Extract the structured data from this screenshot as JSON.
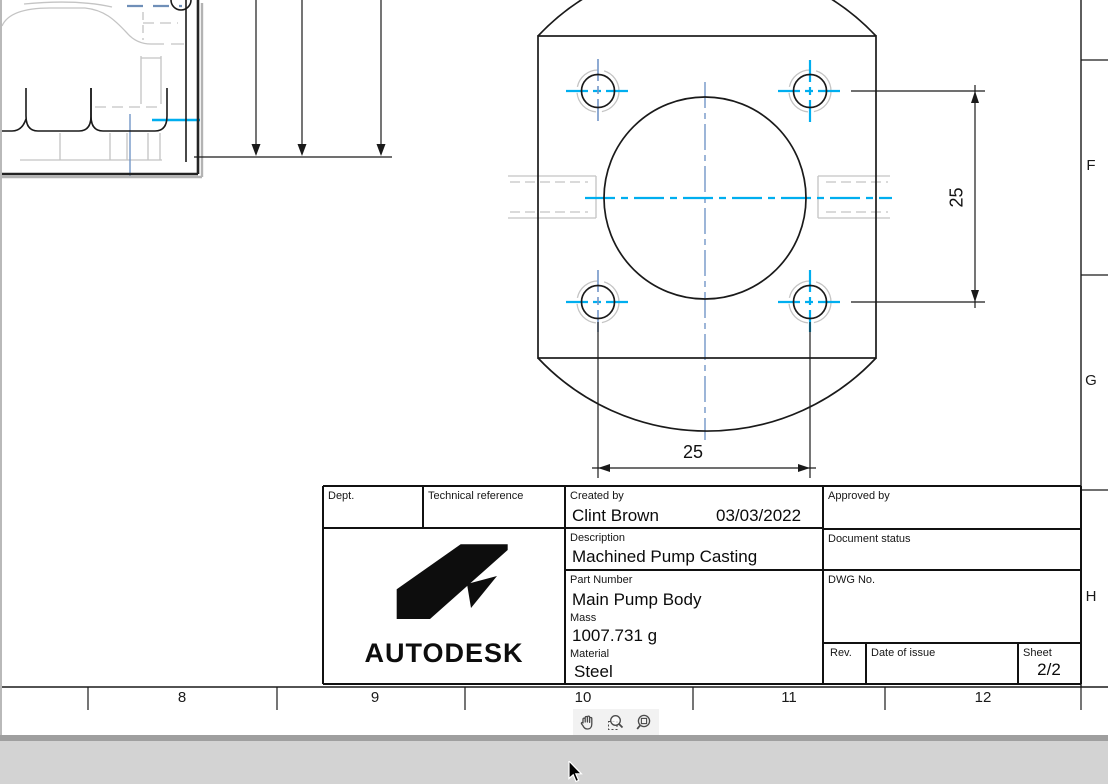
{
  "drawing": {
    "zone_letters": [
      "F",
      "G",
      "H"
    ],
    "ruler_numbers": [
      "8",
      "9",
      "10",
      "11",
      "12"
    ],
    "dimensions": {
      "vertical": "25",
      "horizontal": "25"
    }
  },
  "title_block": {
    "dept_label": "Dept.",
    "technical_reference_label": "Technical reference",
    "created_by_label": "Created by",
    "created_by_value": "Clint Brown",
    "created_date": "03/03/2022",
    "approved_by_label": "Approved by",
    "description_label": "Description",
    "description_value": "Machined Pump Casting",
    "document_status_label": "Document status",
    "part_number_label": "Part Number",
    "part_number_value": "Main Pump Body",
    "mass_label": "Mass",
    "mass_value": "1007.731 g",
    "material_label": "Material",
    "material_value": "Steel",
    "dwg_no_label": "DWG No.",
    "rev_label": "Rev.",
    "date_of_issue_label": "Date of issue",
    "sheet_label": "Sheet",
    "sheet_value": "2/2",
    "brand": "AUTODESK"
  },
  "toolbar": {
    "tools": [
      "pan-hand",
      "zoom-selection",
      "zoom-window"
    ]
  },
  "colors": {
    "line_black": "#1a1a1a",
    "hidden_gray": "#c4c4c4",
    "centerline_blue": "#7396c8",
    "highlight_cyan": "#00aeef",
    "scroll_gray": "#d3d3d3"
  }
}
